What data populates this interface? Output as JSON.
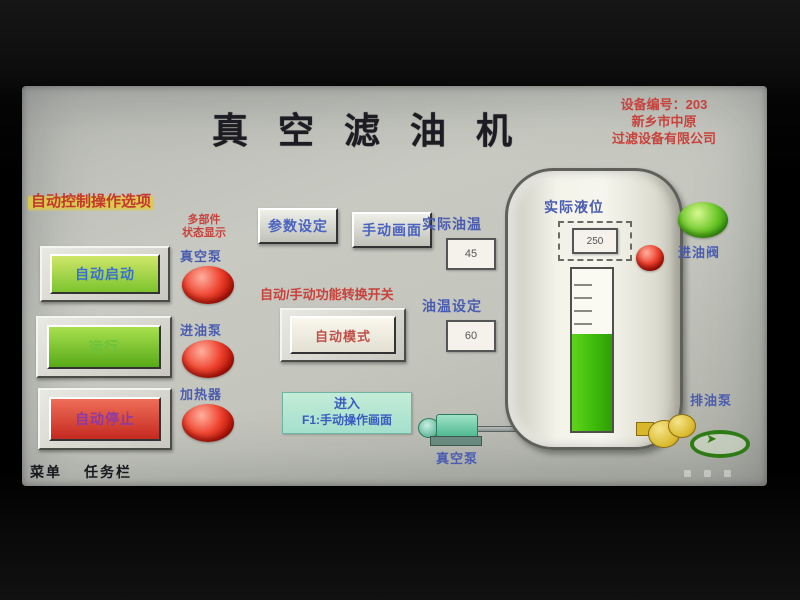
{
  "screen": {
    "title": "真空滤油机",
    "vendor_lines": {
      "line1": "设备编号：203",
      "line2": "新乡市中原",
      "line3": "过滤设备有限公司"
    }
  },
  "left_panel": {
    "header": "自动控制操作选项",
    "note_line1": "多部件",
    "note_line2": "状态显示",
    "buttons": [
      {
        "label": "自动启动"
      },
      {
        "label": "运行"
      },
      {
        "label": "自动停止"
      }
    ]
  },
  "indicator_column": {
    "vacuum_pump_label": "真空泵",
    "oil_pump_label": "进油泵",
    "heater_label": "加热器"
  },
  "center": {
    "param_button": "参数设定",
    "manual_button": "手动画面",
    "temp_actual_label": "实际油温",
    "temp_actual_value": "45",
    "temp_set_label": "油温设定",
    "temp_set_value": "60",
    "mode_header": "自动/手动功能转换开关",
    "mode_button": "自动模式",
    "enter_line1": "进入",
    "enter_line2": "F1:手动操作画面",
    "vacuum_pump_caption": "真空泵"
  },
  "tank": {
    "level_label": "实际液位",
    "level_value": "250",
    "level_percent": 60,
    "valve_label": "进油阀",
    "drain_pump_label": "排油泵"
  },
  "taskbar": {
    "menu": "菜单",
    "tasks": "任务栏"
  },
  "colors": {
    "accent_red": "#c8423c",
    "accent_blue": "#4a5cb0",
    "lamp_red": "#e03020",
    "lamp_green": "#54c21a",
    "level_green": "#3db80a"
  }
}
